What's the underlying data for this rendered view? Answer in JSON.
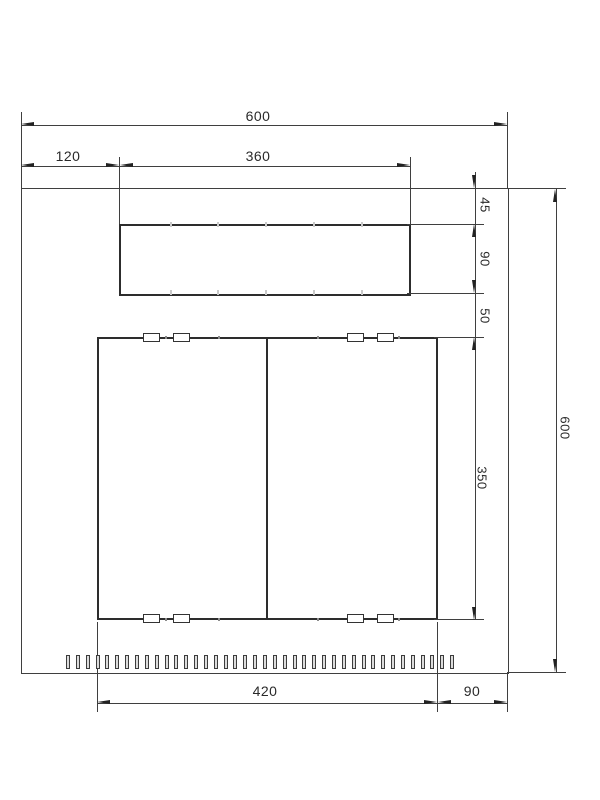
{
  "drawing": {
    "background": "#ffffff",
    "line_color": "#3f3f3f",
    "text_color": "#2a2a2a",
    "labels": {
      "total_width": "600",
      "left_offset": "120",
      "top_panel_width": "360",
      "top_margin": "45",
      "top_panel_height": "90",
      "middle_gap": "50",
      "door_height": "350",
      "total_height": "600",
      "doors_width": "420",
      "right_margin": "90"
    },
    "slots": {
      "count": 40
    },
    "clips": {
      "count": 8
    }
  }
}
